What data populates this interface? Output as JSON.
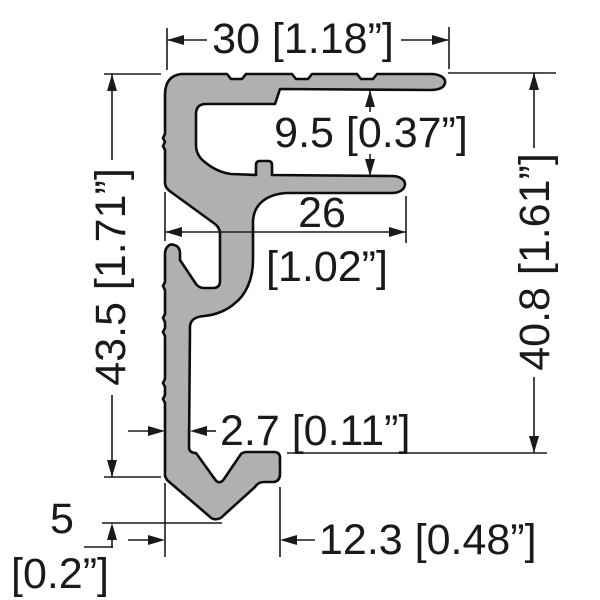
{
  "page": {
    "background": "#ffffff",
    "description": "Dimensioned cross-section drawing of an aluminium extrusion profile"
  },
  "drawing": {
    "profile": {
      "name": "extrusion-profile-cross-section",
      "fill_color": "#b0b0b0",
      "outline_color": "#0d0d0d"
    },
    "dimension_color": "#1a1a1a",
    "dimensions": {
      "top_width": {
        "label": "30 [1.18”]",
        "value_mm": 30,
        "value_in": 1.18
      },
      "flange_gap": {
        "label": "9.5 [0.37”]",
        "value_mm": 9.5,
        "value_in": 0.37
      },
      "mid_width": {
        "label_mm": "26",
        "label_in": "[1.02”]",
        "value_mm": 26,
        "value_in": 1.02
      },
      "left_height": {
        "label": "43.5 [1.71”]",
        "value_mm": 43.5,
        "value_in": 1.71
      },
      "right_height": {
        "label": "40.8 [1.61”]",
        "value_mm": 40.8,
        "value_in": 1.61
      },
      "stem_thickness": {
        "label": "2.7 [0.11”]",
        "value_mm": 2.7,
        "value_in": 0.11
      },
      "tip_offset": {
        "label_mm": "5",
        "label_in": "[0.2”]",
        "value_mm": 5,
        "value_in": 0.2
      },
      "foot_width": {
        "label": "12.3 [0.48”]",
        "value_mm": 12.3,
        "value_in": 0.48
      }
    }
  }
}
